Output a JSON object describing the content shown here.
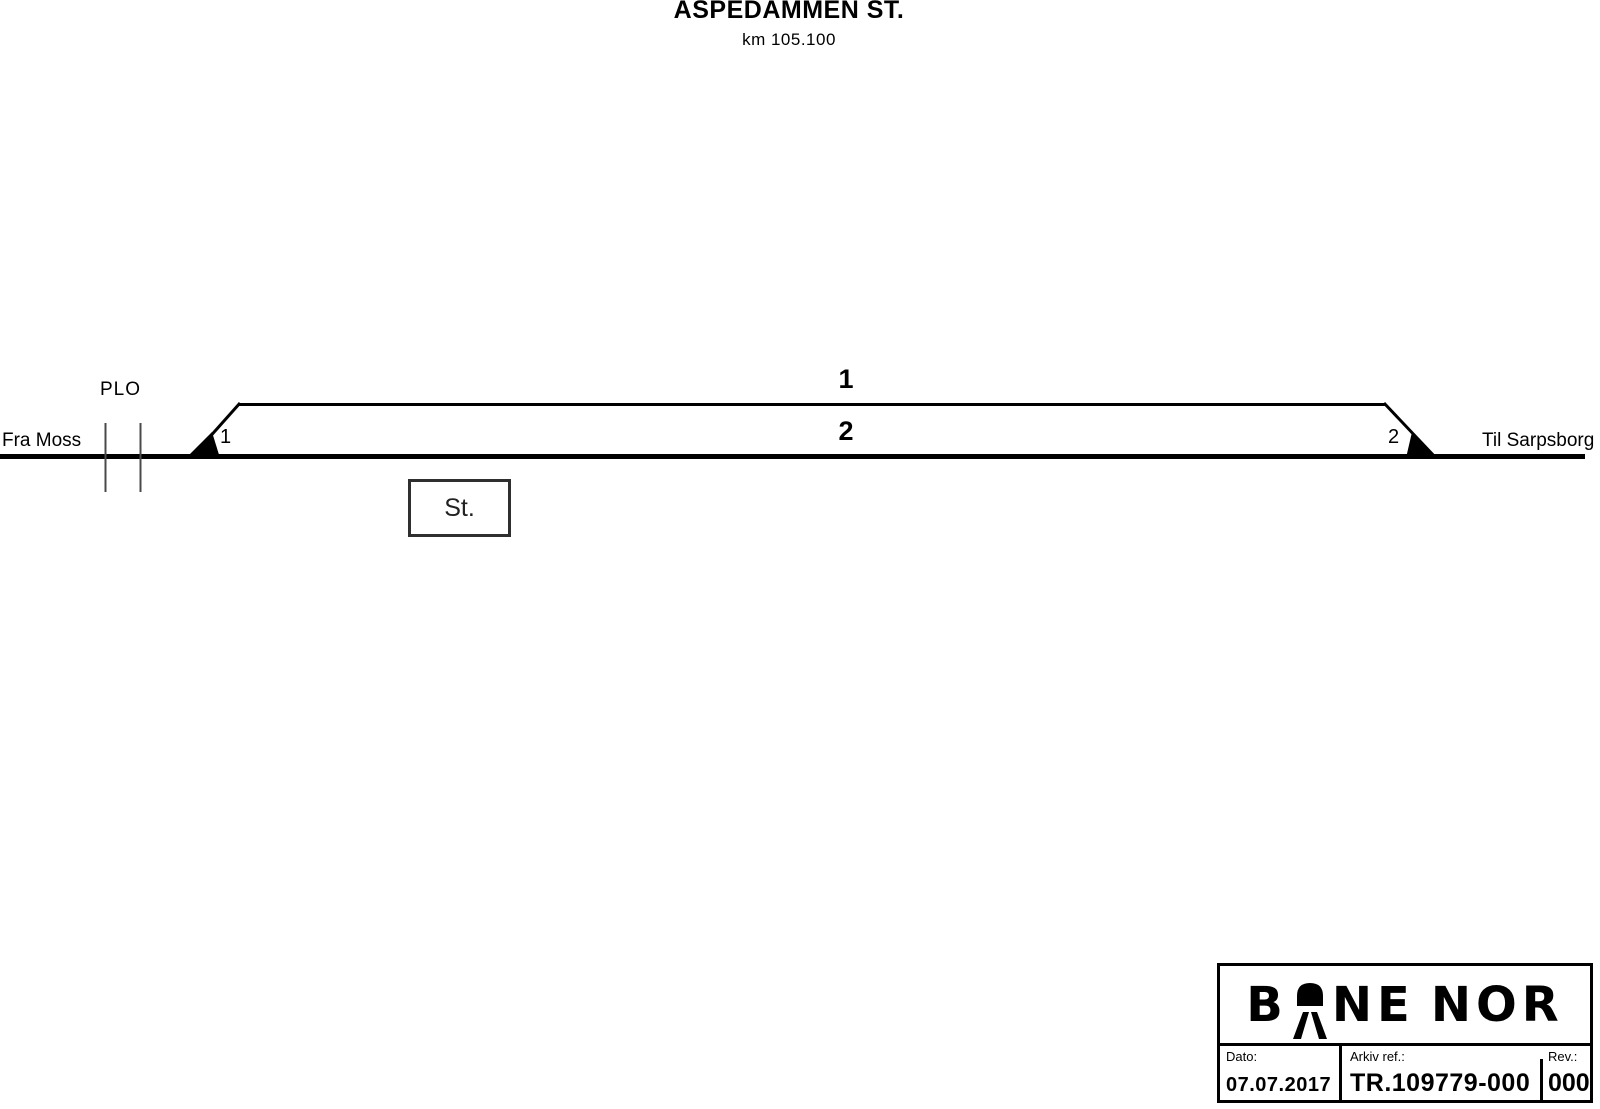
{
  "header": {
    "station_title": "ASPEDAMMEN ST.",
    "km_label": "km 105.100"
  },
  "diagram": {
    "from_label": "Fra Moss",
    "to_label": "Til Sarpsborg",
    "level_crossing_label": "PLO",
    "track_1_number": "1",
    "track_2_number": "2",
    "switch_1_number": "1",
    "switch_2_number": "2",
    "station_building_label": "St."
  },
  "title_block": {
    "logo": {
      "b": "B",
      "ne": "NE",
      "nor": "NOR"
    },
    "date_label": "Dato:",
    "date_value": "07.07.2017",
    "archive_label": "Arkiv ref.:",
    "archive_value": "TR.109779-000",
    "rev_label": "Rev.:",
    "rev_value": "000"
  },
  "colors": {
    "ink": "#000000",
    "thin_line": "#4a4a4a",
    "station_box_border": "#2f2f2f",
    "background": "#ffffff"
  }
}
